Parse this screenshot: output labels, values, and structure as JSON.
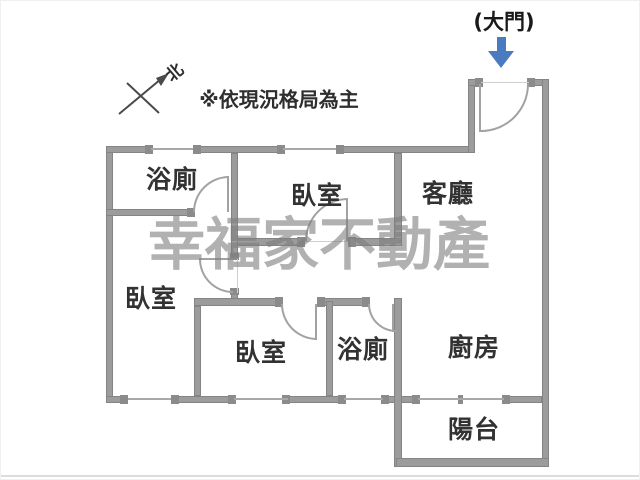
{
  "annotations": {
    "entrance_label": "(大門)",
    "north_label": "北",
    "disclaimer": "※依現況格局為主",
    "watermark": "幸福家不動產"
  },
  "colors": {
    "wall": "#9c9c9c",
    "wall_edge": "#848484",
    "cap": "#8b8b8b",
    "door_line": "#a2a2a2",
    "entrance_arrow_blue": "#4a7bc0",
    "label_text": "#323232",
    "watermark_gray": "#7d7d7d"
  },
  "rooms": [
    {
      "label": "浴廁",
      "x": 171,
      "y": 177
    },
    {
      "label": "臥室",
      "x": 316,
      "y": 193
    },
    {
      "label": "客廳",
      "x": 447,
      "y": 191
    },
    {
      "label": "臥室",
      "x": 150,
      "y": 296
    },
    {
      "label": "臥室",
      "x": 260,
      "y": 350
    },
    {
      "label": "浴廁",
      "x": 362,
      "y": 347
    },
    {
      "label": "廚房",
      "x": 473,
      "y": 345
    },
    {
      "label": "陽台",
      "x": 473,
      "y": 427
    }
  ],
  "floorplan": {
    "walls": [
      [
        105,
        145,
        7,
        257
      ],
      [
        105,
        145,
        45,
        7
      ],
      [
        192,
        145,
        90,
        7
      ],
      [
        335,
        145,
        139,
        7
      ],
      [
        467,
        78,
        7,
        74
      ],
      [
        467,
        78,
        13,
        7
      ],
      [
        528,
        78,
        20,
        7
      ],
      [
        541,
        78,
        7,
        388
      ],
      [
        105,
        395,
        22,
        7
      ],
      [
        170,
        395,
        63,
        7
      ],
      [
        287,
        395,
        56,
        7
      ],
      [
        382,
        395,
        21,
        7
      ],
      [
        395,
        395,
        22,
        7
      ],
      [
        503,
        395,
        38,
        7
      ],
      [
        393,
        297,
        8,
        169
      ],
      [
        395,
        457,
        153,
        9
      ],
      [
        393,
        152,
        8,
        93
      ],
      [
        232,
        237,
        72,
        8
      ],
      [
        347,
        237,
        54,
        8
      ],
      [
        230,
        152,
        7,
        106
      ],
      [
        230,
        292,
        7,
        13
      ],
      [
        105,
        208,
        87,
        7
      ],
      [
        193,
        297,
        87,
        8
      ],
      [
        316,
        297,
        51,
        8
      ],
      [
        193,
        305,
        7,
        90
      ],
      [
        325,
        300,
        7,
        95
      ]
    ],
    "caps": [
      [
        144,
        144,
        8,
        9
      ],
      [
        192,
        144,
        8,
        9
      ],
      [
        276,
        144,
        8,
        9
      ],
      [
        335,
        144,
        8,
        9
      ],
      [
        119,
        394,
        8,
        9
      ],
      [
        170,
        394,
        8,
        9
      ],
      [
        227,
        394,
        8,
        9
      ],
      [
        281,
        394,
        8,
        9
      ],
      [
        337,
        394,
        8,
        9
      ],
      [
        380,
        394,
        8,
        9
      ],
      [
        411,
        394,
        8,
        9
      ],
      [
        501,
        394,
        8,
        9
      ],
      [
        457,
        394,
        5,
        9
      ],
      [
        474,
        77,
        8,
        9
      ],
      [
        526,
        77,
        8,
        9
      ],
      [
        186,
        207,
        8,
        9
      ],
      [
        296,
        236,
        8,
        10
      ],
      [
        347,
        236,
        8,
        10
      ],
      [
        274,
        296,
        8,
        10
      ],
      [
        316,
        296,
        8,
        10
      ],
      [
        361,
        296,
        8,
        10
      ],
      [
        229,
        252,
        9,
        7
      ],
      [
        229,
        287,
        9,
        7
      ]
    ],
    "windows": [
      [
        150,
        147,
        42,
        2
      ],
      [
        282,
        147,
        53,
        2
      ],
      [
        127,
        397,
        43,
        2
      ],
      [
        233,
        397,
        54,
        2
      ],
      [
        343,
        397,
        39,
        2
      ],
      [
        417,
        397,
        86,
        2
      ]
    ],
    "thresholds": [
      [
        304,
        240,
        43,
        1
      ],
      [
        236,
        258,
        1,
        34
      ],
      [
        480,
        81,
        48,
        1
      ]
    ],
    "doors": [
      {
        "box": [
          192,
          175,
          36,
          36
        ],
        "corner": "tl",
        "leaf": [
          226,
          175,
          2,
          36
        ]
      },
      {
        "box": [
          304,
          197,
          43,
          43
        ],
        "corner": "tl",
        "leaf": [
          345,
          197,
          2,
          43
        ]
      },
      {
        "box": [
          198,
          258,
          34,
          34
        ],
        "corner": "bl",
        "leaf": [
          198,
          257,
          34,
          2
        ]
      },
      {
        "box": [
          280,
          303,
          36,
          36
        ],
        "corner": "bl",
        "leaf": [
          314,
          303,
          2,
          36
        ]
      },
      {
        "box": [
          367,
          303,
          28,
          28
        ],
        "corner": "bl",
        "leaf": [
          391,
          303,
          2,
          28
        ]
      },
      {
        "box": [
          480,
          83,
          48,
          48
        ],
        "corner": "br",
        "leaf": [
          478,
          83,
          2,
          48
        ]
      }
    ]
  }
}
